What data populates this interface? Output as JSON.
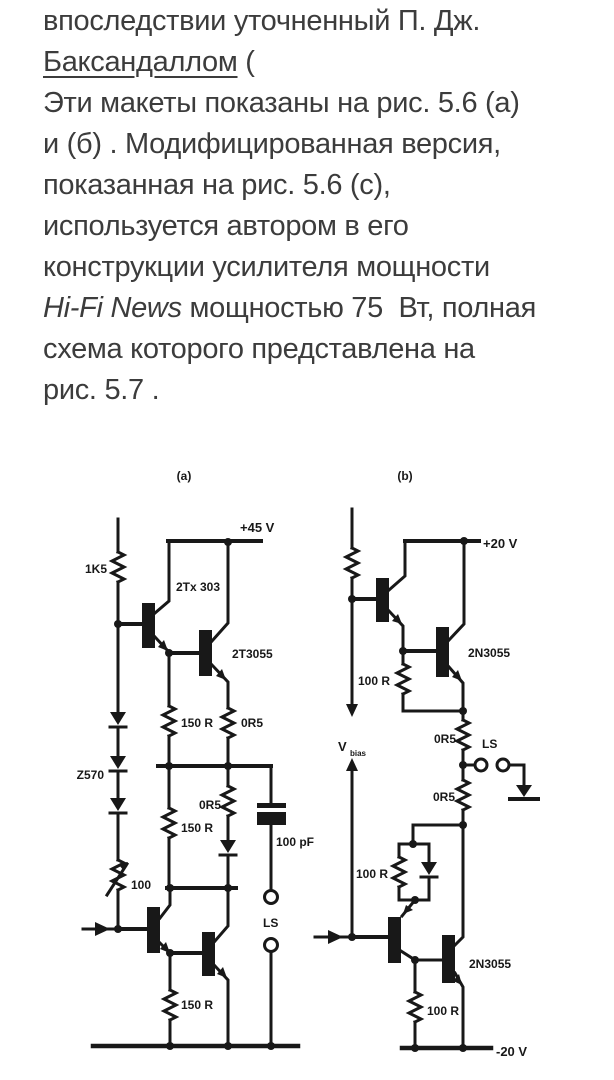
{
  "page": {
    "background": "#ffffff",
    "text_color": "#3c3c3c",
    "ink_color": "#181818"
  },
  "text": {
    "line1": "впоследствии уточненный П. Дж.",
    "line2_link": "Баксандаллом",
    "line2_rest": " (",
    "line3": "Эти макеты показаны на рис. 5.6 (а)",
    "line4": "и (б) . Модифицированная версия,",
    "line5": "показанная на рис. 5.6 (с),",
    "line6": "используется автором в его",
    "line7": "конструкции усилителя мощности",
    "line8_italic": "Hi-Fi News",
    "line8_rest": " мощностью 75  Вт, полная",
    "line9": "схема которого представлена на",
    "line10": "рис. 5.7 ."
  },
  "figure": {
    "panel_a": {
      "label": "(a)",
      "supply": "+45 V",
      "r_input": "1K5",
      "q_driver": "2Tx 303",
      "q_output": "2T3055",
      "r_150_upper": "150 R",
      "r_0r5_upper": "0R5",
      "diode_chain": "Z570",
      "r_0r5_lower": "0R5",
      "r_150_mid": "150 R",
      "capacitor": "100 pF",
      "preset": "100",
      "speaker": "LS",
      "r_150_bottom": "150 R"
    },
    "panel_b": {
      "label": "(b)",
      "supply_pos": "+20 V",
      "q_output_upper": "2N3055",
      "r_100_upper": "100 R",
      "r_0r5_upper": "0R5",
      "speaker": "LS",
      "r_0r5_lower": "0R5",
      "r_100_mid": "100 R",
      "q_output_lower": "2N3055",
      "r_100_bottom": "100 R",
      "supply_neg": "-20 V",
      "vbias_v": "V",
      "vbias_sub": "bias"
    }
  }
}
